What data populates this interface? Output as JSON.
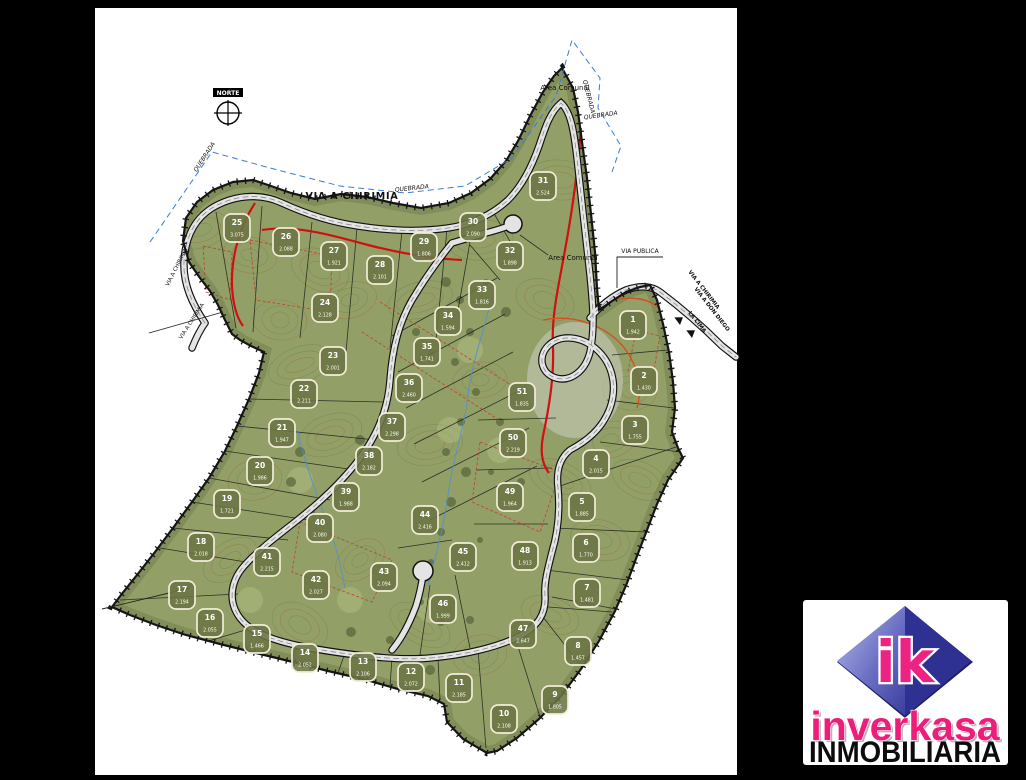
{
  "window": {
    "background": "#000000",
    "sheet_color": "#ffffff"
  },
  "map": {
    "labels": {
      "norte": "NORTE",
      "via_a_chirimia": "VIA A CHIRIMIA",
      "quebrada": "QUEBRADA",
      "area_comunal": "Area Comunal",
      "via_publica": "VIA PUBLICA",
      "via_a_don_diego": "VIA A DON DIEGO",
      "la_cima": "LA CIMA"
    },
    "colors": {
      "terrain": "#92a067",
      "contour": "#6e7b47",
      "contour_accent": "#a2643c",
      "boundary": "#151515",
      "road_fill": "#e4e4e4",
      "red_line": "#d01010",
      "orange_line": "#d2501e",
      "quebrada_line": "#3a7bd5",
      "lot_box_fill": "#6b7444",
      "lot_box_stroke": "#f2edd7"
    },
    "lots": [
      {
        "n": "1",
        "area": "1.942",
        "x": 633,
        "y": 325
      },
      {
        "n": "2",
        "area": "1.430",
        "x": 644,
        "y": 381
      },
      {
        "n": "3",
        "area": "1.755",
        "x": 635,
        "y": 430
      },
      {
        "n": "4",
        "area": "2.015",
        "x": 596,
        "y": 464
      },
      {
        "n": "5",
        "area": "1.885",
        "x": 582,
        "y": 507
      },
      {
        "n": "6",
        "area": "1.770",
        "x": 586,
        "y": 548
      },
      {
        "n": "7",
        "area": "1.481",
        "x": 587,
        "y": 593
      },
      {
        "n": "8",
        "area": "1.457",
        "x": 578,
        "y": 651
      },
      {
        "n": "9",
        "area": "1.805",
        "x": 555,
        "y": 700
      },
      {
        "n": "10",
        "area": "2.108",
        "x": 504,
        "y": 719
      },
      {
        "n": "11",
        "area": "2.185",
        "x": 459,
        "y": 688
      },
      {
        "n": "12",
        "area": "2.072",
        "x": 411,
        "y": 677
      },
      {
        "n": "13",
        "area": "2.106",
        "x": 363,
        "y": 667
      },
      {
        "n": "14",
        "area": "2.052",
        "x": 305,
        "y": 658
      },
      {
        "n": "15",
        "area": "1.466",
        "x": 257,
        "y": 639
      },
      {
        "n": "16",
        "area": "2.055",
        "x": 210,
        "y": 623
      },
      {
        "n": "17",
        "area": "2.194",
        "x": 182,
        "y": 595
      },
      {
        "n": "18",
        "area": "2.018",
        "x": 201,
        "y": 547
      },
      {
        "n": "19",
        "area": "1.721",
        "x": 227,
        "y": 504
      },
      {
        "n": "20",
        "area": "1.986",
        "x": 260,
        "y": 471
      },
      {
        "n": "21",
        "area": "1.947",
        "x": 282,
        "y": 433
      },
      {
        "n": "22",
        "area": "2.211",
        "x": 304,
        "y": 394
      },
      {
        "n": "23",
        "area": "2.001",
        "x": 333,
        "y": 361
      },
      {
        "n": "24",
        "area": "2.128",
        "x": 325,
        "y": 308
      },
      {
        "n": "25",
        "area": "3.075",
        "x": 237,
        "y": 228
      },
      {
        "n": "26",
        "area": "2.088",
        "x": 286,
        "y": 242
      },
      {
        "n": "27",
        "area": "1.921",
        "x": 334,
        "y": 256
      },
      {
        "n": "28",
        "area": "2.101",
        "x": 380,
        "y": 270
      },
      {
        "n": "29",
        "area": "1.806",
        "x": 424,
        "y": 247
      },
      {
        "n": "30",
        "area": "2.090",
        "x": 473,
        "y": 227
      },
      {
        "n": "31",
        "area": "2.524",
        "x": 543,
        "y": 186
      },
      {
        "n": "32",
        "area": "1.898",
        "x": 510,
        "y": 256
      },
      {
        "n": "33",
        "area": "1.816",
        "x": 482,
        "y": 295
      },
      {
        "n": "34",
        "area": "1.594",
        "x": 448,
        "y": 321
      },
      {
        "n": "35",
        "area": "1.741",
        "x": 427,
        "y": 352
      },
      {
        "n": "36",
        "area": "2.460",
        "x": 409,
        "y": 388
      },
      {
        "n": "37",
        "area": "2.298",
        "x": 392,
        "y": 427
      },
      {
        "n": "38",
        "area": "2.182",
        "x": 369,
        "y": 461
      },
      {
        "n": "39",
        "area": "1.988",
        "x": 346,
        "y": 497
      },
      {
        "n": "40",
        "area": "2.080",
        "x": 320,
        "y": 528
      },
      {
        "n": "41",
        "area": "2.215",
        "x": 267,
        "y": 562
      },
      {
        "n": "42",
        "area": "2.027",
        "x": 316,
        "y": 585
      },
      {
        "n": "43",
        "area": "2.094",
        "x": 384,
        "y": 577
      },
      {
        "n": "44",
        "area": "2.416",
        "x": 425,
        "y": 520
      },
      {
        "n": "45",
        "area": "2.412",
        "x": 463,
        "y": 557
      },
      {
        "n": "46",
        "area": "1.999",
        "x": 443,
        "y": 609
      },
      {
        "n": "47",
        "area": "2.647",
        "x": 523,
        "y": 634
      },
      {
        "n": "48",
        "area": "1.913",
        "x": 525,
        "y": 556
      },
      {
        "n": "49",
        "area": "1.964",
        "x": 510,
        "y": 497
      },
      {
        "n": "50",
        "area": "2.219",
        "x": 513,
        "y": 443
      },
      {
        "n": "51",
        "area": "1.835",
        "x": 522,
        "y": 397
      }
    ]
  },
  "logo": {
    "brand": "inverkasa",
    "subtitle": "INMOBILIARIA",
    "monogram": "ik",
    "accent": "#ec1e79",
    "diamond_dark": "#2e3192",
    "diamond_light": "#9ca0dd"
  }
}
